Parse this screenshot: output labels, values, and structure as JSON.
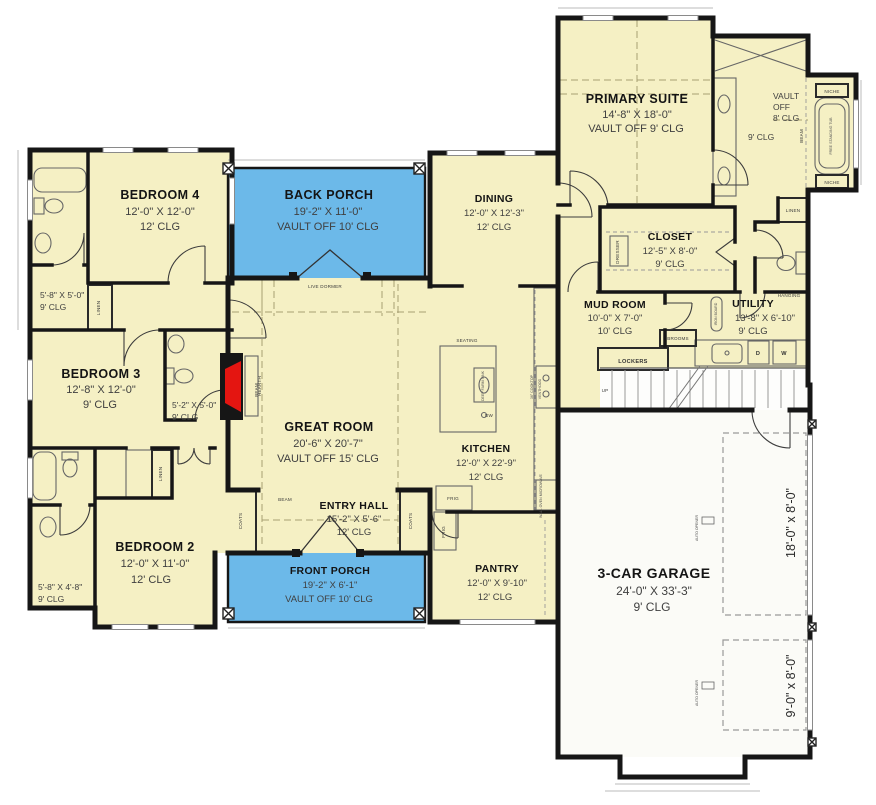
{
  "plan_title": "First Floor Plan",
  "colors": {
    "room_fill": "#f5f0c4",
    "porch_fill": "#6cb9e9",
    "garage_fill": "#fbfbf7",
    "wall": "#161616",
    "fireplace_red": "#e41511"
  },
  "rooms": {
    "bedroom4": {
      "name": "BEDROOM 4",
      "dims": "12'-0\" X 12'-0\"",
      "clg": "12' CLG"
    },
    "back_porch": {
      "name": "BACK PORCH",
      "dims": "19'-2\" X 11'-0\"",
      "clg": "VAULT OFF 10' CLG"
    },
    "dining": {
      "name": "DINING",
      "dims": "12'-0\" X 12'-3\"",
      "clg": "12' CLG"
    },
    "primary_suite": {
      "name": "PRIMARY SUITE",
      "dims": "14'-8\" X 18'-0\"",
      "clg": "VAULT OFF 9' CLG"
    },
    "primary_bath": {
      "vault1": "VAULT",
      "vault2": "OFF",
      "vault3": "8' CLG",
      "clg": "9' CLG"
    },
    "closet": {
      "name": "CLOSET",
      "dims": "12'-5\" X 8'-0\"",
      "clg": "9' CLG"
    },
    "mud_room": {
      "name": "MUD ROOM",
      "dims": "10'-0\" X 7'-0\"",
      "clg": "10' CLG"
    },
    "utility": {
      "name": "UTILITY",
      "dims": "13'-8\" X 6'-10\"",
      "clg": "9' CLG"
    },
    "bedroom3": {
      "name": "BEDROOM 3",
      "dims": "12'-8\" X 12'-0\"",
      "clg": "9' CLG"
    },
    "great_room": {
      "name": "GREAT ROOM",
      "dims": "20'-6\" X 20'-7\"",
      "clg": "VAULT OFF 15' CLG"
    },
    "kitchen": {
      "name": "KITCHEN",
      "dims": "12'-0\" X 22'-9\"",
      "clg": "12' CLG"
    },
    "entry_hall": {
      "name": "ENTRY HALL",
      "dims": "15'-2\" X 5'-6\"",
      "clg": "12' CLG"
    },
    "bedroom2": {
      "name": "BEDROOM 2",
      "dims": "12'-0\" X 11'-0\"",
      "clg": "12' CLG"
    },
    "front_porch": {
      "name": "FRONT PORCH",
      "dims": "19'-2\" X 6'-1\"",
      "clg": "VAULT OFF 10' CLG"
    },
    "pantry": {
      "name": "PANTRY",
      "dims": "12'-0\" X 9'-10\"",
      "clg": "12' CLG"
    },
    "garage": {
      "name": "3-CAR GARAGE",
      "dims": "24'-0\" X 33'-3\"",
      "clg": "9' CLG"
    },
    "bath_top_left": {
      "dims": "5'-8\" X 5'-0\"",
      "clg": "9' CLG"
    },
    "bath_mid_left": {
      "dims": "5'-2\" X 5'-0\"",
      "clg": "9' CLG"
    },
    "bath_bottom_left": {
      "dims": "5'-8\" X 4'-8\"",
      "clg": "9' CLG"
    }
  },
  "labels": {
    "live_dormer": "LIVE DORMER",
    "beam": "BEAM",
    "hearth": "HEARTH",
    "seating": "SEATING",
    "linen": "LINEN",
    "coats": "COATS",
    "lockers": "LOCKERS",
    "brooms": "BROOMS",
    "hanging": "HANGING",
    "dresser": "DRESSER",
    "iron_board": "IRON BOARD",
    "up": "UP",
    "niche": "NICHE",
    "free_standing_tub": "FREE STANDING TUB",
    "frig": "FRIG",
    "dw": "DW",
    "washer": "W",
    "dryer": "D",
    "deep_farm_sink": "DEEP FARM SINK",
    "cooktop": "36\" COOKTOP",
    "venthood": "VENTHOOD",
    "wall_oven": "WALL OVEN MICROWAVE",
    "auto_opener": "AUTO OPENER",
    "garage_door_large": "18'-0\" x 8'-0\"",
    "garage_door_small": "9'-0\" x 8'-0\""
  }
}
